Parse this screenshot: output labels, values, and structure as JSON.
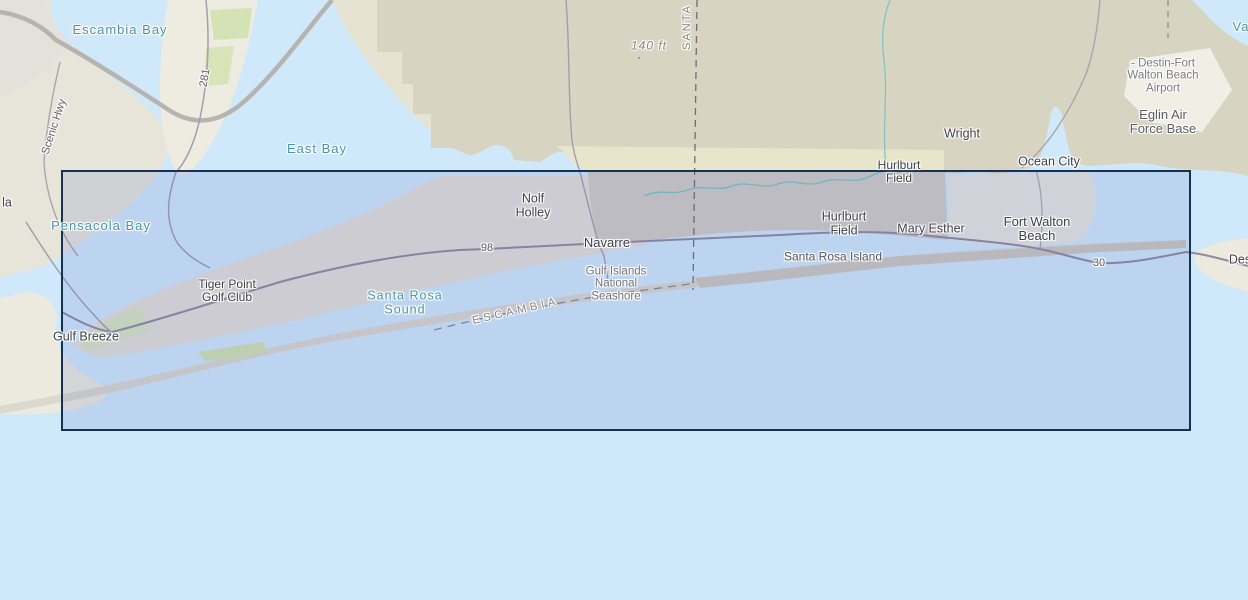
{
  "map": {
    "water_labels": {
      "escambia_bay": "Escambia Bay",
      "east_bay": "East Bay",
      "pensacola_bay": "Pensacola Bay",
      "santa_rosa_sound_line1": "Santa Rosa",
      "santa_rosa_sound_line2": "Sound",
      "valparaiso_partial": "Va"
    },
    "place_labels": {
      "gulf_breeze": "Gulf Breeze",
      "tiger_point_line1": "Tiger Point",
      "tiger_point_line2": "Golf Club",
      "nolf_holley_line1": "Nolf",
      "nolf_holley_line2": "Holley",
      "navarre": "Navarre",
      "hurlburt_north_line1": "Hurlburt",
      "hurlburt_north_line2": "Field",
      "hurlburt_main_line1": "Hurlburt",
      "hurlburt_main_line2": "Field",
      "mary_esther": "Mary Esther",
      "fort_walton_beach_line1": "Fort Walton",
      "fort_walton_beach_line2": "Beach",
      "wright": "Wright",
      "ocean_city": "Ocean City",
      "santa_rosa_island": "Santa Rosa Island",
      "destin_partial": "Des",
      "pensacola_partial": "la"
    },
    "area_labels": {
      "gulf_islands_line1": "Gulf Islands",
      "gulf_islands_line2": "National",
      "gulf_islands_line3": "Seashore",
      "eglin_line1": "Eglin Air",
      "eglin_line2": "Force Base",
      "destin_airport_line1": "- Destin-Fort",
      "destin_airport_line2": "Walton Beach",
      "destin_airport_line3": "Airport"
    },
    "county_labels": {
      "santa_rosa": "SANTA",
      "escambia": "ESCAMBIA"
    },
    "road_labels": {
      "us98": "98",
      "sr30": "30",
      "sr281": "281",
      "scenic_hwy": "Scenic Hwy"
    },
    "elevation_label": "140 ft"
  },
  "selection_box": {
    "border_color": "#16324e",
    "fill_color": "rgba(80,95,190,0.15)"
  },
  "colors": {
    "water": "#cfe9fa",
    "land": "#e9e6d8",
    "military_land": "#d6d3c1",
    "wetland": "#ebe9cc",
    "island": "#d9d6cc",
    "park_green": "#cfe2ae",
    "water_label": "#4b93a8",
    "place_label": "#3f3f48",
    "stream": "#7ac4c4"
  }
}
